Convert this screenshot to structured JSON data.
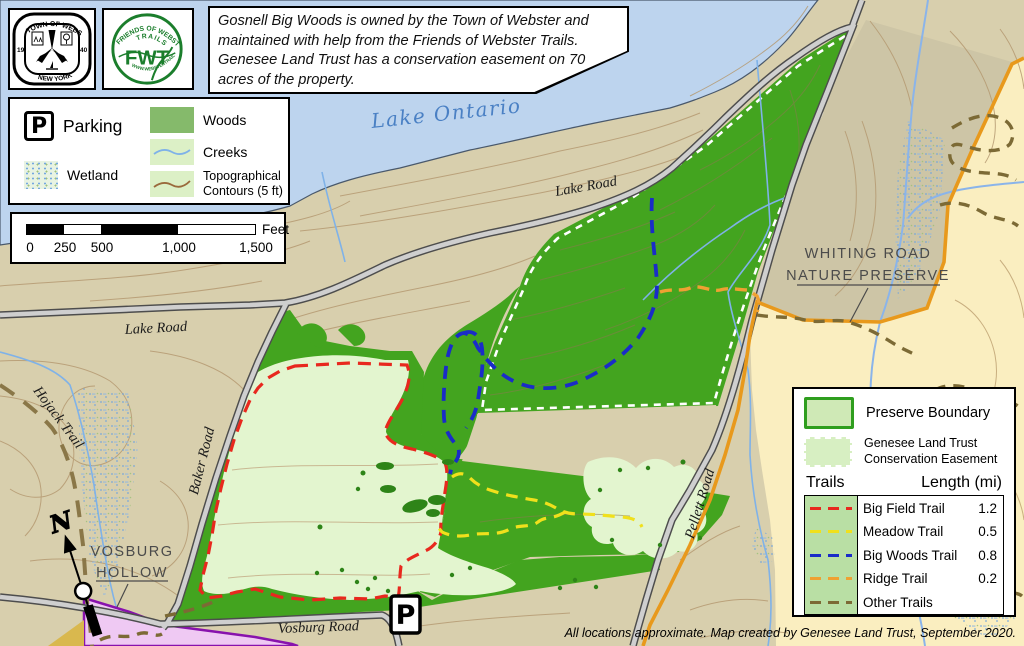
{
  "header": {
    "info_text": "Gosnell Big Woods is owned by the Town of Webster and maintained with help from the Friends of Webster Trails. Genesee Land Trust has a conservation easement on 70 acres of the property.",
    "seal": {
      "top": "TOWN OF WEBSTER",
      "bottom": "NEW YORK",
      "left": "19",
      "right": "40"
    },
    "fwt": {
      "arc_top": "FRIENDS OF WEBSTER",
      "arc_mid": "TRAILS",
      "center": "FWT",
      "arc_bottom": "WWW.WEBSTERTRAILS.ORG"
    }
  },
  "legend": {
    "parking": "Parking",
    "wetland": "Wetland",
    "woods": "Woods",
    "creeks": "Creeks",
    "topo": "Topographical Contours (5 ft)"
  },
  "scale_bar": {
    "ticks": [
      "0",
      "250",
      "500",
      "1,000",
      "1,500"
    ],
    "unit": "Feet"
  },
  "map_labels": {
    "lake": "Lake Ontario",
    "lake_road_north": "Lake Road",
    "lake_road_west": "Lake Road",
    "baker_road": "Baker Road",
    "pellett_road": "Pellett Road",
    "vosburg_road": "Vosburg Road",
    "hojack_trail": "Hojack Trail",
    "whiting_line1": "WHITING ROAD",
    "whiting_line2": "NATURE PRESERVE",
    "vosburg_line1": "VOSBURG",
    "vosburg_line2": "HOLLOW",
    "north": "N",
    "parking_symbol": "P"
  },
  "boundary_legend": {
    "preserve": "Preserve Boundary",
    "easement_line1": "Genesee Land Trust",
    "easement_line2": "Conservation Easement"
  },
  "trails_table": {
    "col_trails": "Trails",
    "col_length": "Length (mi)",
    "rows": [
      {
        "name": "Big Field Trail",
        "length": "1.2",
        "color": "#e8281e"
      },
      {
        "name": "Meadow Trail",
        "length": "0.5",
        "color": "#f0e01c"
      },
      {
        "name": "Big Woods Trail",
        "length": "0.8",
        "color": "#1a2cc8"
      },
      {
        "name": "Ridge Trail",
        "length": "0.2",
        "color": "#efa132"
      },
      {
        "name": "Other Trails",
        "length": "",
        "color": "#7c6a35"
      }
    ]
  },
  "attribution": "All locations approximate. Map created by Genesee Land Trust, September 2020.",
  "colors": {
    "lake": "#bdd4ee",
    "land_tan": "#d8cfad",
    "whiting_pale": "#faeec0",
    "woods_dark": "#43a41f",
    "field_light": "#e3f5cf",
    "legend_woods": "#85ba6b",
    "whiting_boundary": "#e8991c",
    "vosburg_hollow_fill": "#efc9f3",
    "vosburg_hollow_border": "#8812ad",
    "road_fill": "#cfcfcf",
    "road_casing": "#4d4d4d",
    "contour": "#b59a72"
  }
}
